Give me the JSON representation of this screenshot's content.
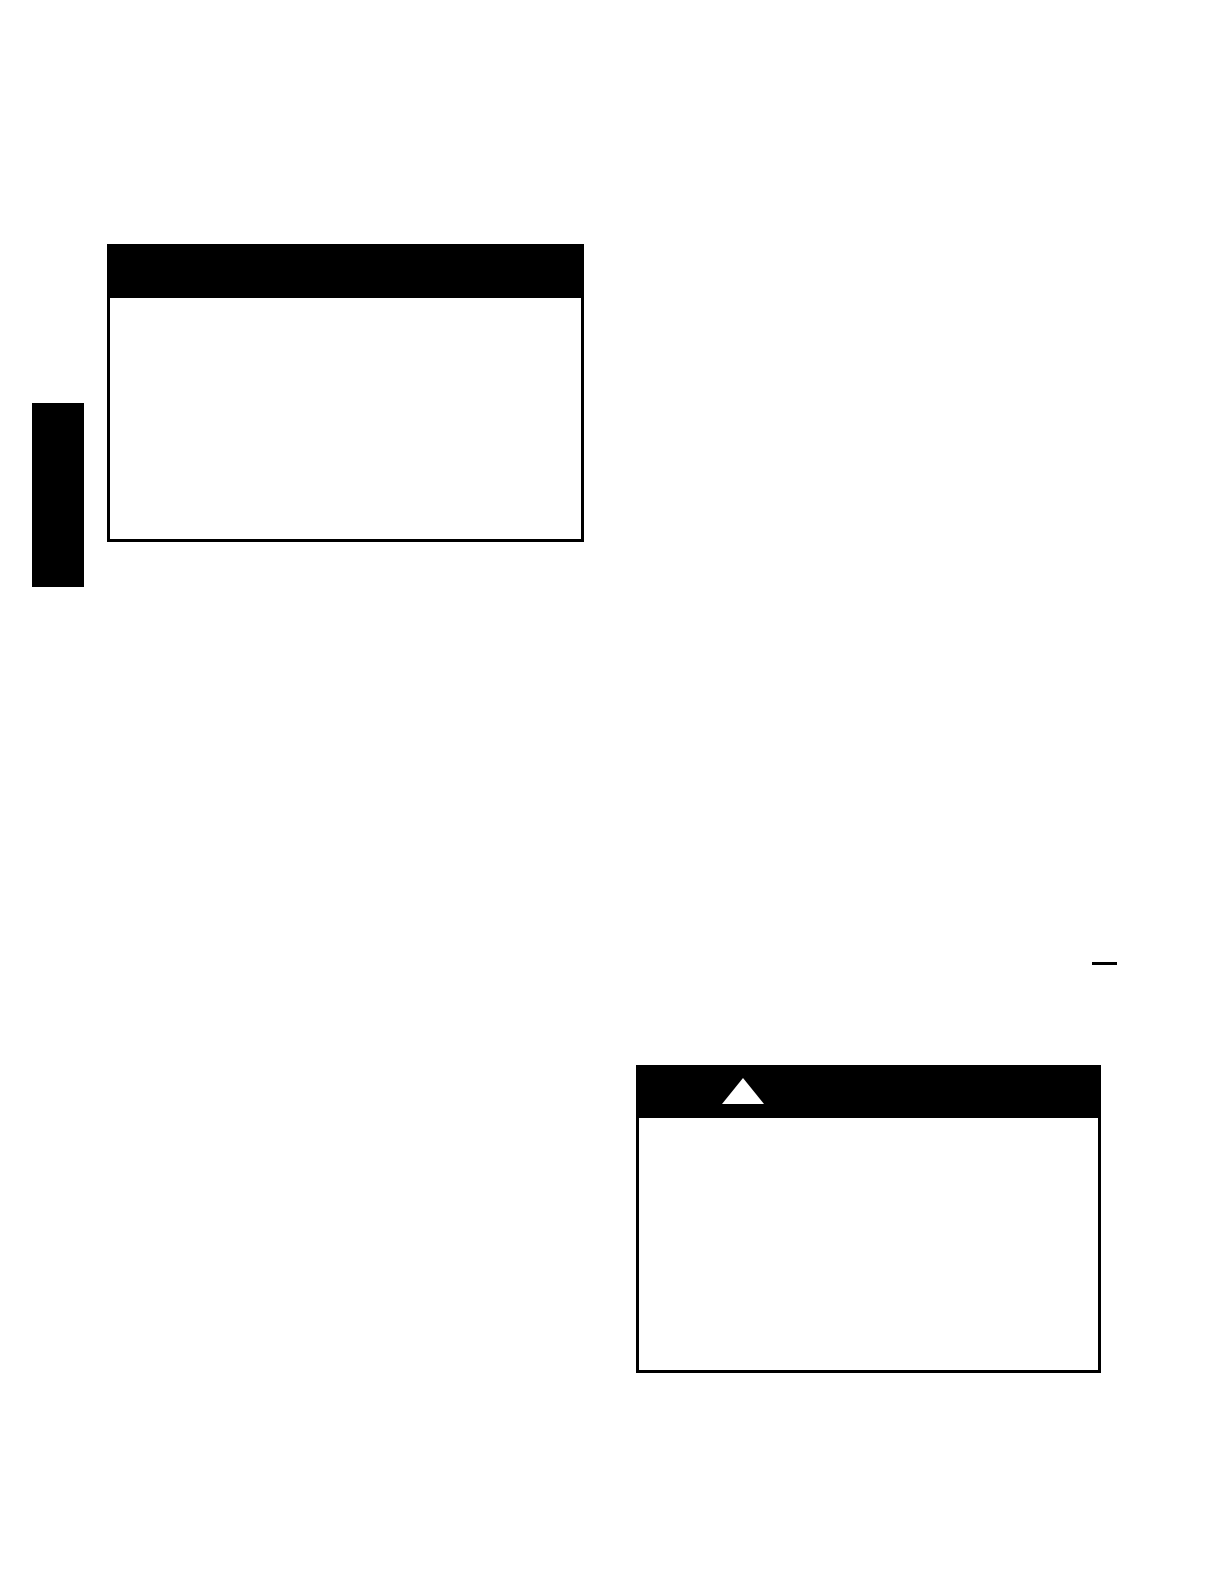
{
  "document": {
    "background_color": "#ffffff",
    "ink_color": "#000000"
  },
  "notice_box": {
    "header_color": "#000000",
    "body_color": "#ffffff"
  },
  "section_tab": {
    "color": "#000000"
  },
  "warning_box": {
    "header_color": "#000000",
    "body_color": "#ffffff",
    "icon": "warning-triangle-icon",
    "icon_color": "#ffffff",
    "icon_points": "21,0 42,26 0,26"
  },
  "underline_mark": {
    "color": "#000000"
  }
}
